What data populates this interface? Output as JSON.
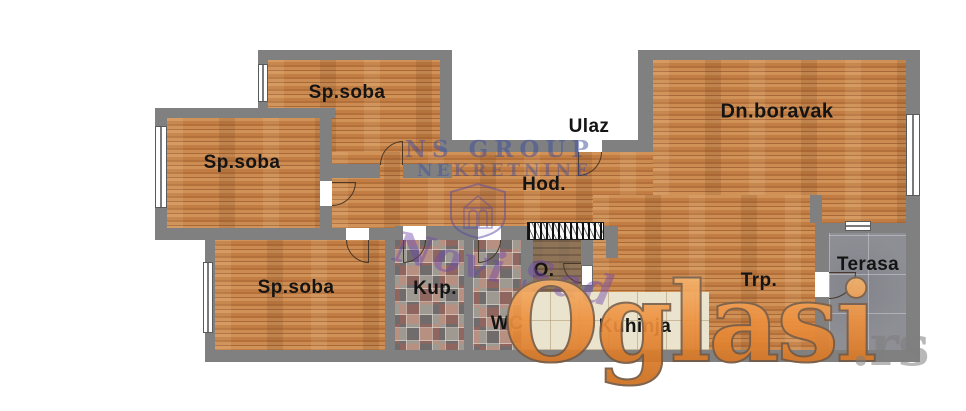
{
  "plan": {
    "rooms": [
      {
        "id": "bedroom-top",
        "label": "Sp.soba"
      },
      {
        "id": "bedroom-left",
        "label": "Sp.soba"
      },
      {
        "id": "bedroom-bottom",
        "label": "Sp.soba"
      },
      {
        "id": "entrance",
        "label": "Ulaz"
      },
      {
        "id": "hallway",
        "label": "Hod."
      },
      {
        "id": "living-room",
        "label": "Dn.boravak"
      },
      {
        "id": "bathroom",
        "label": "Kup."
      },
      {
        "id": "wc",
        "label": "WC"
      },
      {
        "id": "pantry",
        "label": "O."
      },
      {
        "id": "kitchen",
        "label": "Kuhinja"
      },
      {
        "id": "dining",
        "label": "Trp."
      },
      {
        "id": "terrace",
        "label": "Terasa"
      }
    ],
    "colors": {
      "wall": "#808080",
      "wood_floor": "#c4824a",
      "kitchen_tile": "#eae3cd",
      "terrace_tile": "#8e8e95",
      "label_text": "#141414"
    }
  },
  "watermarks": {
    "agency": {
      "line1": "NS GROUP",
      "line2": "NEKRETNINE",
      "script": "Novi Sad",
      "color": "#3a4c9e"
    },
    "portal": {
      "name": "Oglasi",
      "suffix": ".rs",
      "color": "#ec8b38"
    }
  }
}
